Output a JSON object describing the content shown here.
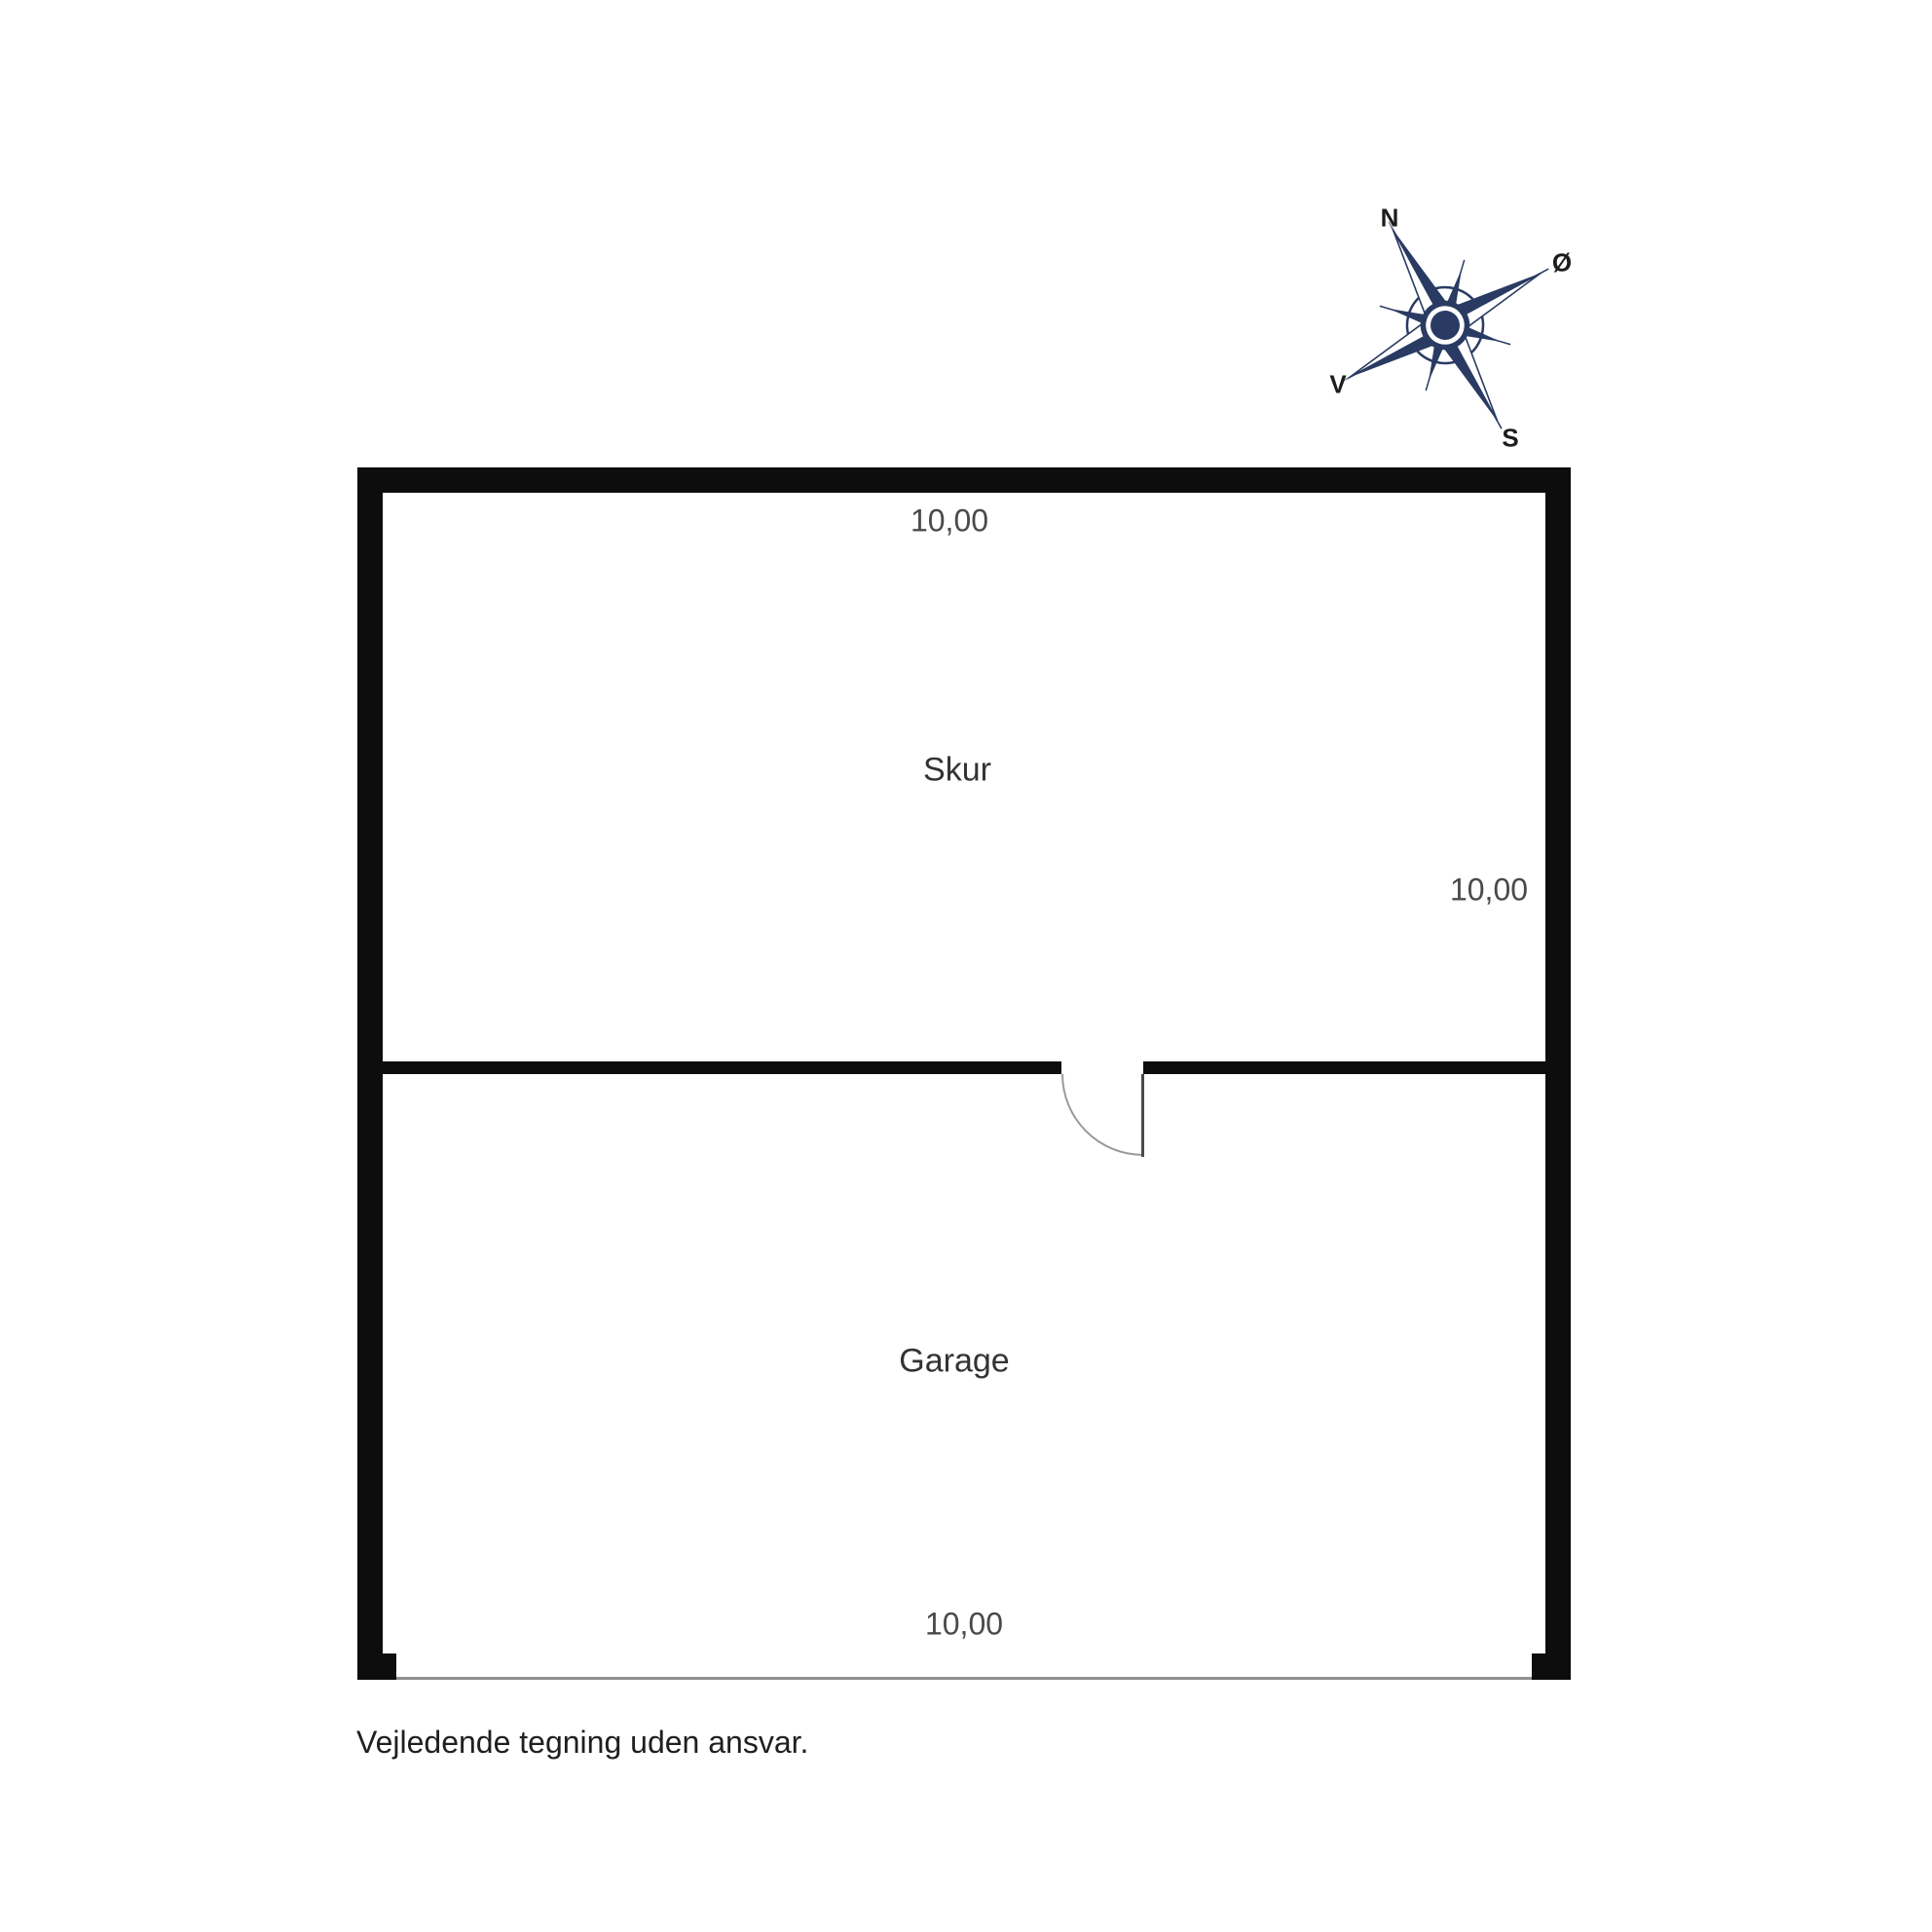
{
  "rooms": [
    {
      "name": "Skur"
    },
    {
      "name": "Garage"
    }
  ],
  "dimensions": {
    "top": "10,00",
    "right": "10,00",
    "bottom": "10,00"
  },
  "disclaimer": "Vejledende tegning uden ansvar.",
  "compass": {
    "n": "N",
    "e": "Ø",
    "s": "S",
    "w": "V"
  },
  "colors": {
    "wall": "#0d0d0d",
    "compass": "#2a3b63",
    "dimText": "#4a4a4a",
    "roomText": "#333333",
    "disclaimerText": "#1f1f1f",
    "thinLine": "#8f8f8f",
    "doorArc": "#9a9a9a",
    "doorLeaf": "#4a4a4a"
  }
}
